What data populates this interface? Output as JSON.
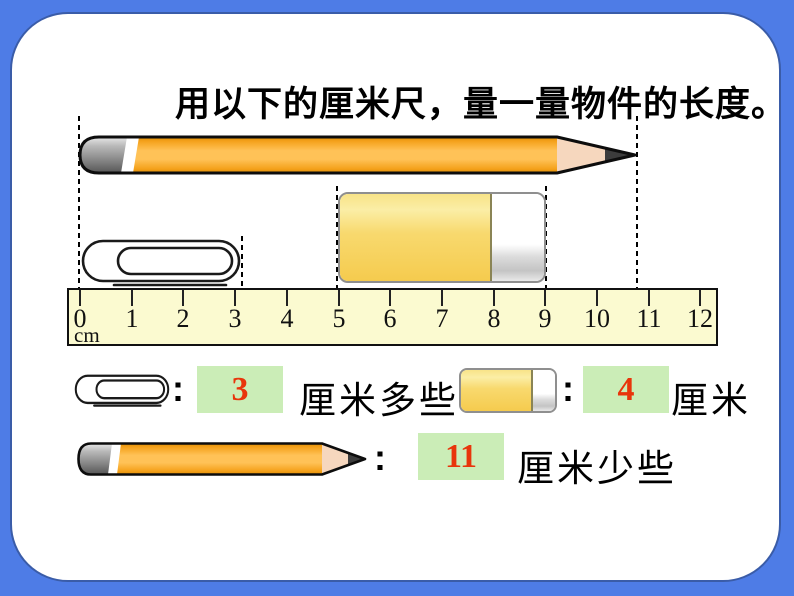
{
  "title": "用以下的厘米尺，量一量物件的长度。",
  "ruler": {
    "unit_label": "cm",
    "ticks": [
      "0",
      "1",
      "2",
      "3",
      "4",
      "5",
      "6",
      "7",
      "8",
      "9",
      "10",
      "11",
      "12"
    ]
  },
  "answers": {
    "colon": ":",
    "paperclip": {
      "value": "3",
      "unit_text": "厘米多些"
    },
    "eraser": {
      "value": "4",
      "unit_text": "厘米"
    },
    "pencil": {
      "value": "11",
      "unit_text": "厘米少些"
    }
  },
  "icons": {
    "pencil": "pencil-illustration",
    "paperclip": "paperclip-illustration",
    "eraser": "eraser-illustration"
  },
  "colors": {
    "frame_blue": "#4E7CE6",
    "card_border_blue": "#3A5CA8",
    "ruler_fill": "#FBFAD0",
    "answer_box_green": "#CBEDB7",
    "answer_value_red": "#E8350B",
    "pencil_orange": "#F5A21C",
    "eraser_yellow": "#F5CB4E"
  }
}
